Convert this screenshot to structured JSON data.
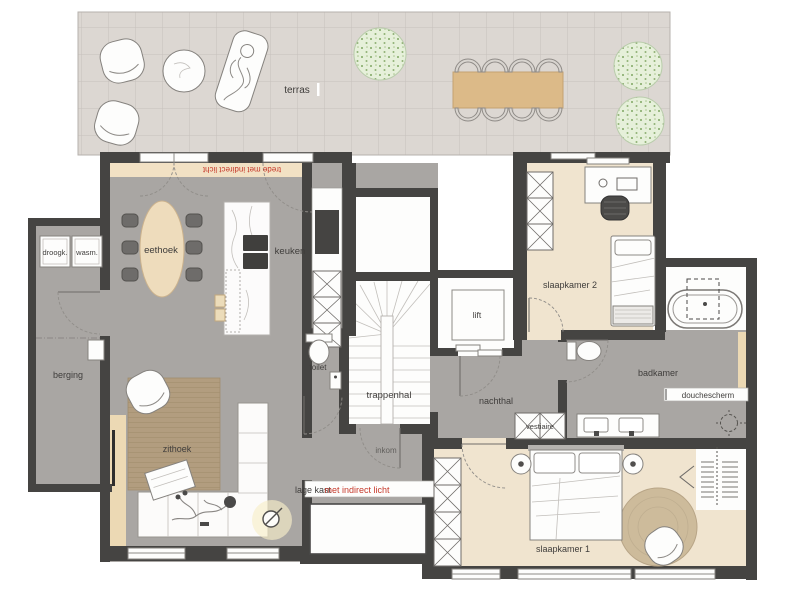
{
  "plan": {
    "labels": {
      "terras": "terras",
      "trede": "trede met indirect licht",
      "droogk": "droogk.",
      "wasm": "wasm.",
      "berging": "berging",
      "eethoek": "eethoek",
      "keuken": "keuken",
      "zithoek": "zithoek",
      "toilet": "toilet",
      "trappenhal": "trappenhal",
      "inkom": "inkom",
      "lage_kast": "lage kast",
      "lage_kast_accent": "met indirect licht",
      "lift": "lift",
      "slaapkamer2": "slaapkamer 2",
      "nachthal": "nachthal",
      "vestiaire": "vestiaire",
      "badkamer": "badkamer",
      "douchescherm": "douchescherm",
      "slaapkamer1": "slaapkamer 1"
    },
    "colors": {
      "wall": "#454442",
      "floor_gray": "#a9a6a3",
      "floor_wood": "#f0e4cf",
      "terrace_tile": "#dcd7d2",
      "step": "#f2e1c4",
      "accent_red": "#c6392b",
      "wood": "#dcba88",
      "rug_living": "#b29d7f",
      "rug_bedroom": "#cdbb9b",
      "tree": "#e6f0da",
      "label": "#3f3d3b",
      "cream": "#ecd9b4"
    }
  }
}
